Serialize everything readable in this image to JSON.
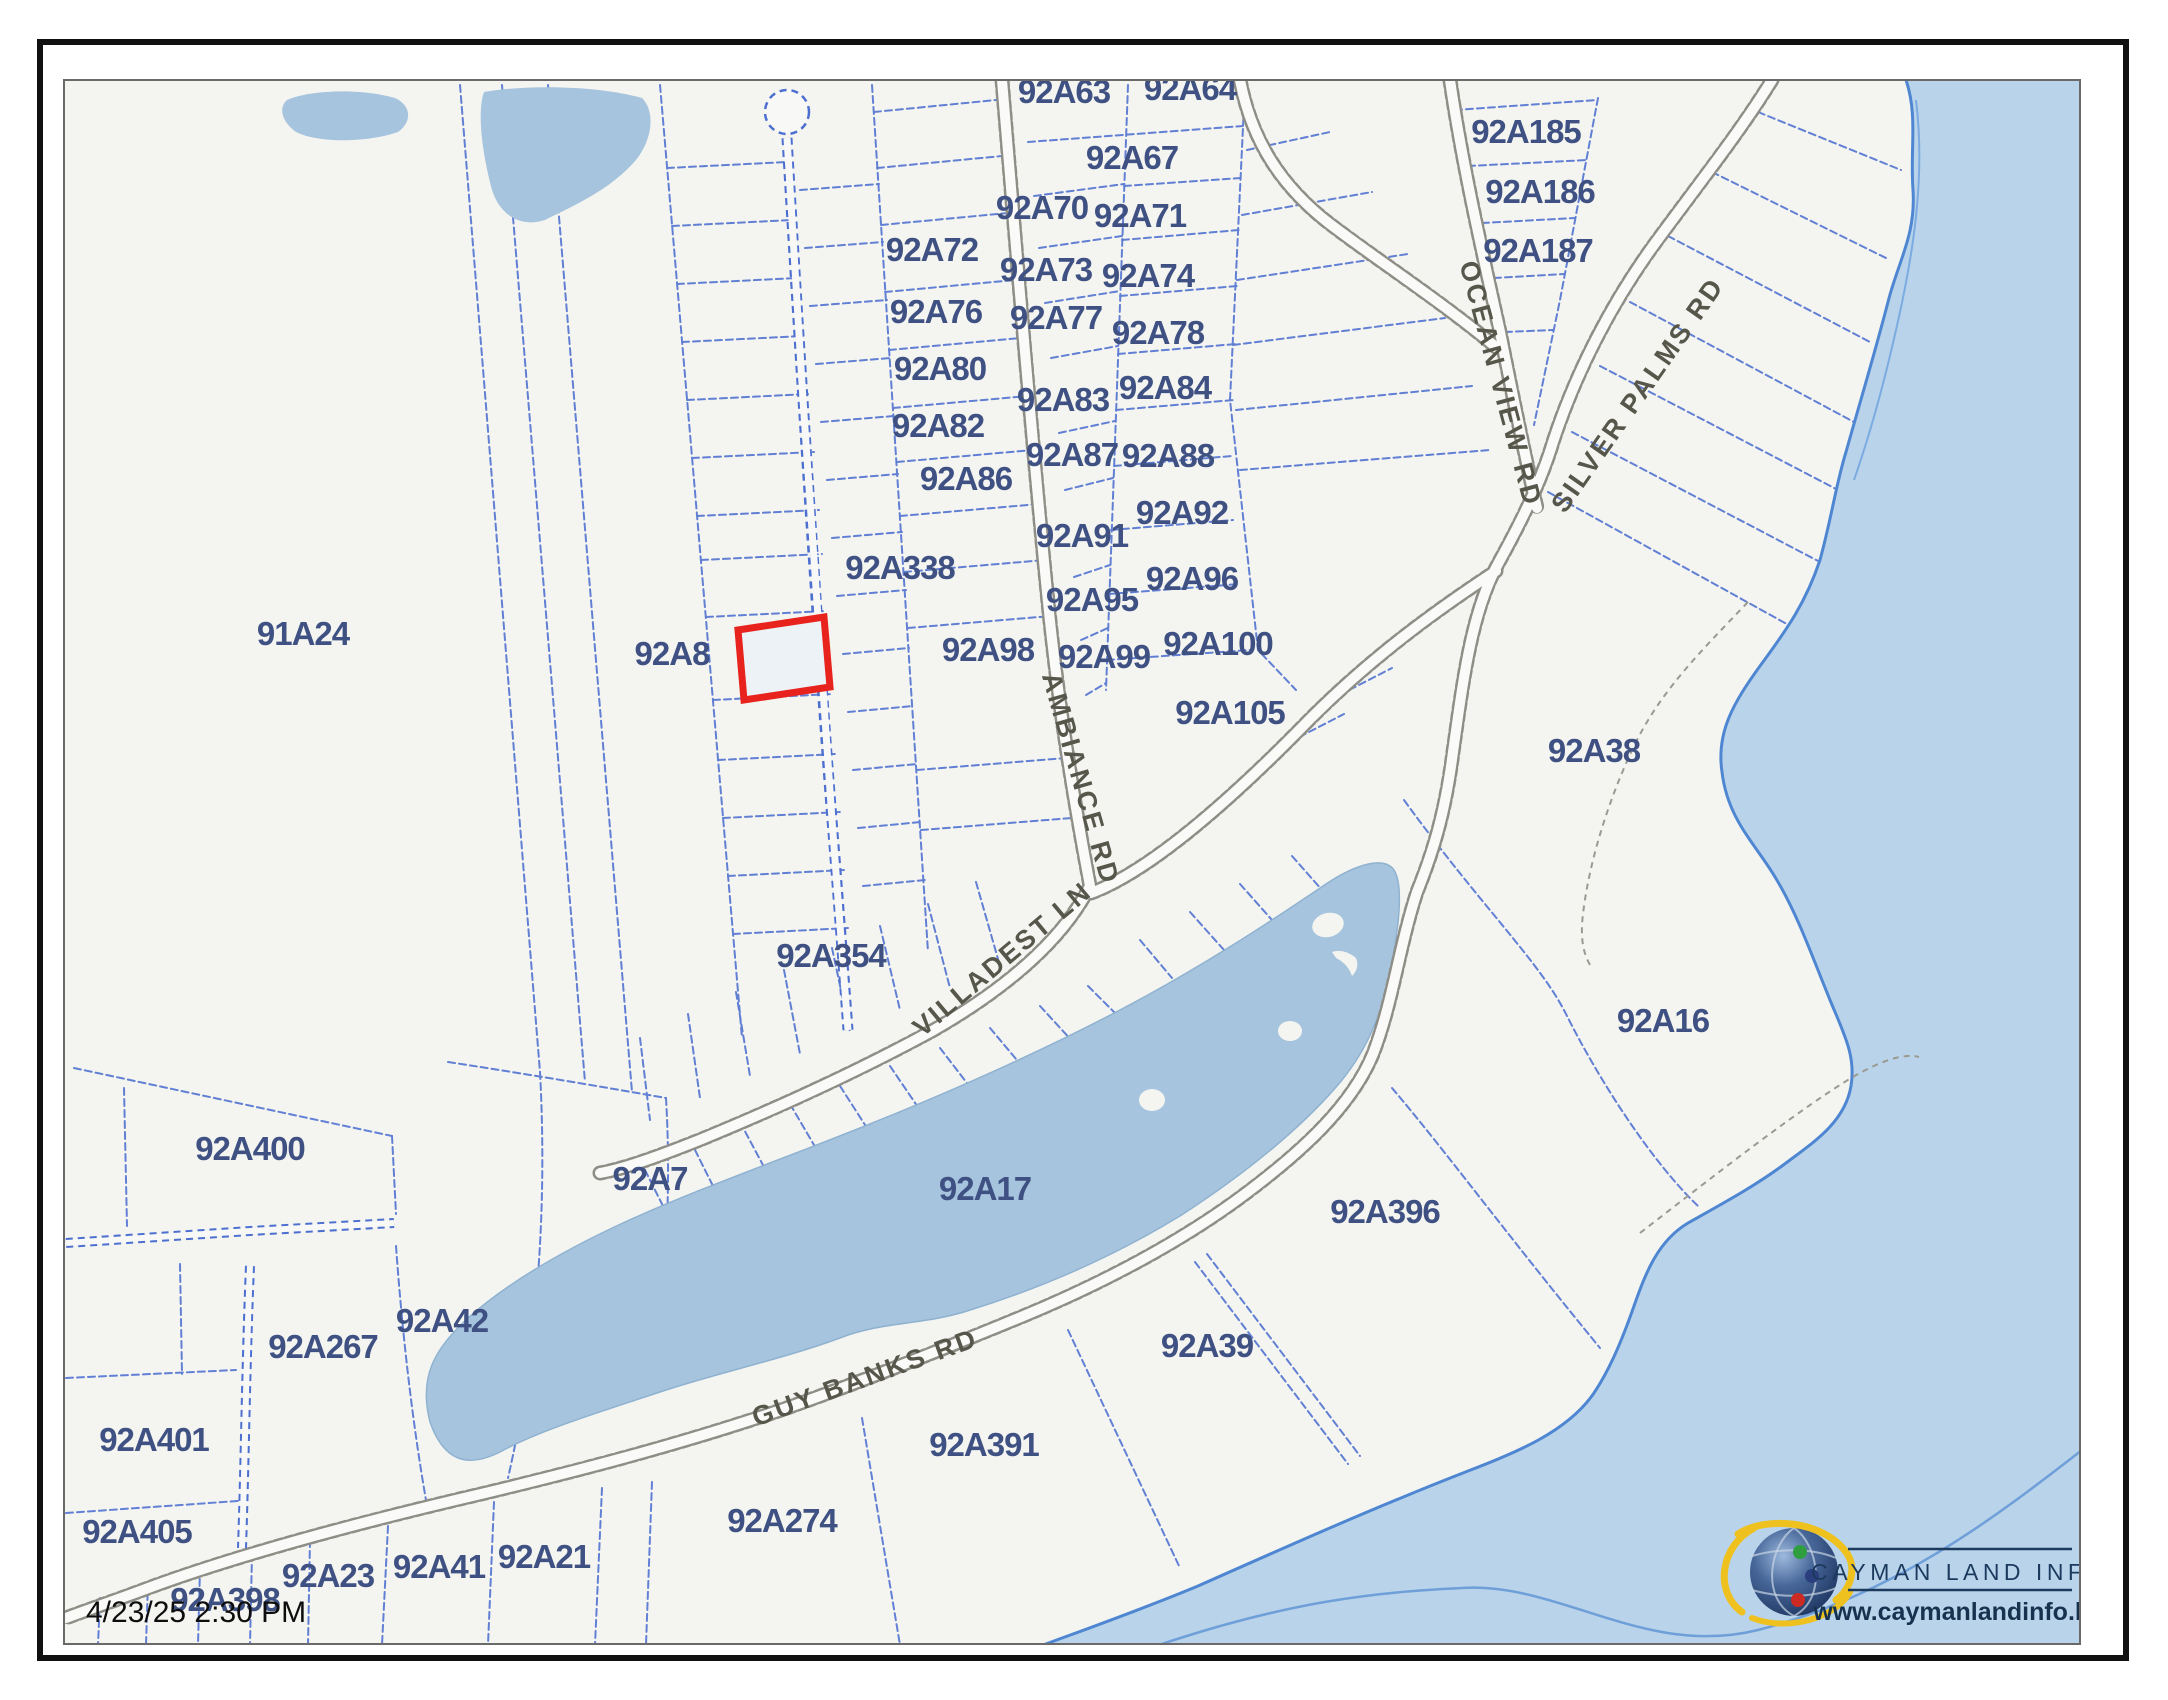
{
  "timestamp": "4/23/25 2:30 PM",
  "logo": {
    "title": "CAYMAN LAND INFO",
    "url": "www.caymanlandinfo.ky"
  },
  "colors": {
    "ocean": "#b9d4ea",
    "pond": "#a6c4dd",
    "land": "#f4f5f1",
    "parcel_line": "#4d6fd0",
    "road_edge": "#8e8e86",
    "parcel_label": "#3f5183",
    "road_label": "#56564a",
    "highlight": "#e8231d",
    "coast": "#4f86d2",
    "frame": "#111111",
    "logo_navy": "#1c3a5e"
  },
  "selected_parcel": {
    "note": "red outlined parcel west of 92A8 strip lane"
  },
  "parcel_labels": [
    {
      "id": "92A63",
      "x": 1064,
      "y": 103
    },
    {
      "id": "92A64",
      "x": 1190,
      "y": 100
    },
    {
      "id": "92A67",
      "x": 1132,
      "y": 169
    },
    {
      "id": "92A70",
      "x": 1042,
      "y": 219
    },
    {
      "id": "92A71",
      "x": 1140,
      "y": 227
    },
    {
      "id": "92A72",
      "x": 932,
      "y": 261
    },
    {
      "id": "92A73",
      "x": 1046,
      "y": 281
    },
    {
      "id": "92A74",
      "x": 1148,
      "y": 287
    },
    {
      "id": "92A76",
      "x": 936,
      "y": 323
    },
    {
      "id": "92A77",
      "x": 1056,
      "y": 329
    },
    {
      "id": "92A78",
      "x": 1158,
      "y": 344
    },
    {
      "id": "92A80",
      "x": 940,
      "y": 380
    },
    {
      "id": "92A83",
      "x": 1063,
      "y": 411
    },
    {
      "id": "92A84",
      "x": 1165,
      "y": 399
    },
    {
      "id": "92A82",
      "x": 938,
      "y": 437
    },
    {
      "id": "92A87",
      "x": 1072,
      "y": 466
    },
    {
      "id": "92A88",
      "x": 1168,
      "y": 467
    },
    {
      "id": "92A86",
      "x": 966,
      "y": 490
    },
    {
      "id": "92A92",
      "x": 1182,
      "y": 524
    },
    {
      "id": "92A91",
      "x": 1082,
      "y": 547
    },
    {
      "id": "92A96",
      "x": 1192,
      "y": 590
    },
    {
      "id": "92A95",
      "x": 1092,
      "y": 611
    },
    {
      "id": "92A338",
      "x": 900,
      "y": 579
    },
    {
      "id": "92A98",
      "x": 988,
      "y": 661
    },
    {
      "id": "92A99",
      "x": 1104,
      "y": 668
    },
    {
      "id": "92A100",
      "x": 1218,
      "y": 655
    },
    {
      "id": "92A105",
      "x": 1230,
      "y": 724
    },
    {
      "id": "92A185",
      "x": 1526,
      "y": 143
    },
    {
      "id": "92A186",
      "x": 1540,
      "y": 203
    },
    {
      "id": "92A187",
      "x": 1538,
      "y": 262
    },
    {
      "id": "91A24",
      "x": 303,
      "y": 645
    },
    {
      "id": "92A8",
      "x": 672,
      "y": 665
    },
    {
      "id": "92A38",
      "x": 1594,
      "y": 762
    },
    {
      "id": "92A16",
      "x": 1663,
      "y": 1032
    },
    {
      "id": "92A354",
      "x": 831,
      "y": 967
    },
    {
      "id": "92A7",
      "x": 650,
      "y": 1190
    },
    {
      "id": "92A17",
      "x": 985,
      "y": 1200
    },
    {
      "id": "92A400",
      "x": 250,
      "y": 1160
    },
    {
      "id": "92A42",
      "x": 442,
      "y": 1332
    },
    {
      "id": "92A267",
      "x": 323,
      "y": 1358
    },
    {
      "id": "92A401",
      "x": 154,
      "y": 1451
    },
    {
      "id": "92A405",
      "x": 137,
      "y": 1543
    },
    {
      "id": "92A398",
      "x": 225,
      "y": 1611
    },
    {
      "id": "92A23",
      "x": 328,
      "y": 1587
    },
    {
      "id": "92A41",
      "x": 439,
      "y": 1578
    },
    {
      "id": "92A21",
      "x": 544,
      "y": 1568
    },
    {
      "id": "92A274",
      "x": 782,
      "y": 1532
    },
    {
      "id": "92A391",
      "x": 984,
      "y": 1456
    },
    {
      "id": "92A39",
      "x": 1207,
      "y": 1357
    },
    {
      "id": "92A396",
      "x": 1385,
      "y": 1223
    }
  ],
  "road_labels": [
    {
      "name": "OCEAN VIEW RD",
      "x": 1492,
      "y": 386,
      "rot": 75
    },
    {
      "name": "SILVER PALMS RD",
      "x": 1645,
      "y": 400,
      "rot": -55
    },
    {
      "name": "AMBIANCE RD",
      "x": 1072,
      "y": 781,
      "rot": 74
    },
    {
      "name": "VILLADEST LN",
      "x": 1008,
      "y": 966,
      "rot": -40
    },
    {
      "name": "GUY BANKS RD",
      "x": 868,
      "y": 1386,
      "rot": -20
    }
  ]
}
